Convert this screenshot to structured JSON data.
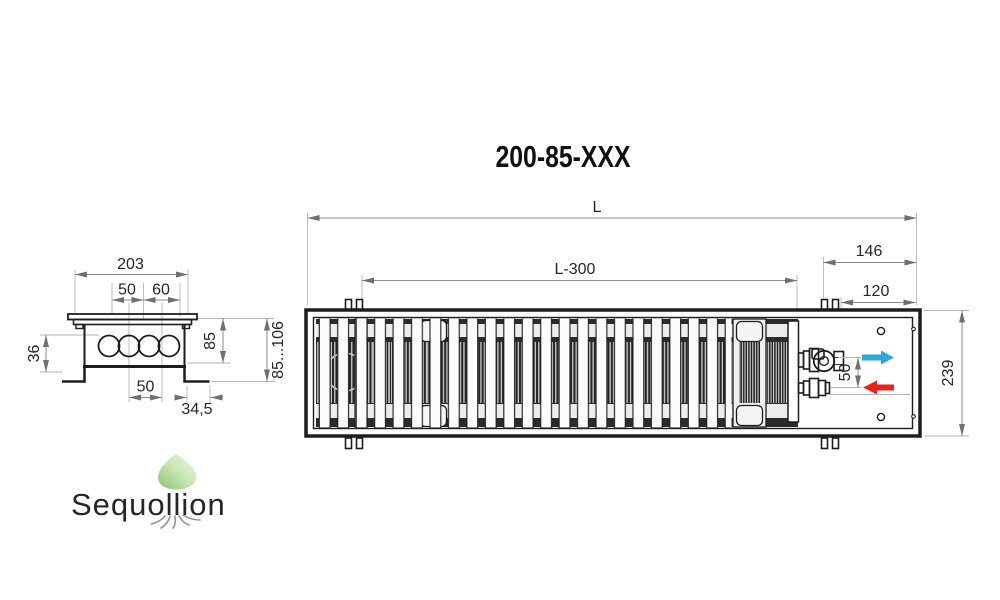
{
  "title": "200-85-XXX",
  "watermark": {
    "brand": "Sequollion"
  },
  "colors": {
    "flow_in": "#2aa7dd",
    "flow_out": "#e52420",
    "logo_green_dark": "#8fc172",
    "logo_green_mid": "#c8e5b2",
    "logo_green_light": "#eff8e7",
    "logo_text": "#9e9287"
  },
  "side_view": {
    "label_width_top": "203",
    "label_inner_left": "50",
    "label_inner_right": "60",
    "label_height_left": "36",
    "label_height_body": "85",
    "label_height_adjustable": "85...106",
    "label_bottom_spacing": "50",
    "label_foot": "34,5"
  },
  "top_view": {
    "label_length": "L",
    "label_grille_length": "L-300",
    "label_end_section": "146",
    "label_connection": "120",
    "label_pipe_spacing": "50",
    "label_width": "239"
  }
}
